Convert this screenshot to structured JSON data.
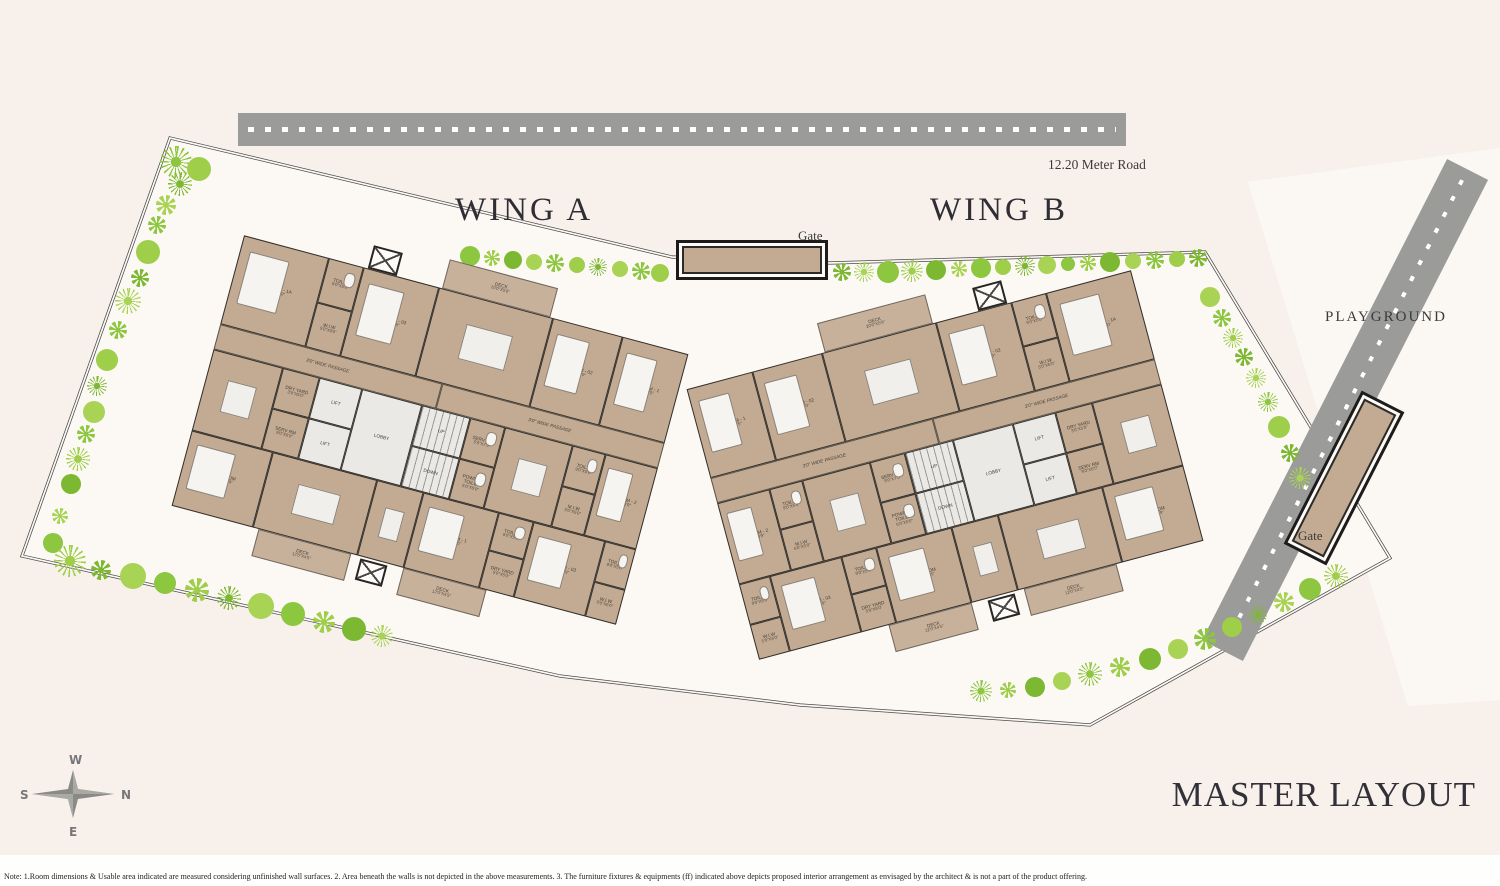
{
  "labels": {
    "wing_a": "WING A",
    "wing_b": "WING B",
    "playground": "PLAYGROUND",
    "road_top": "12.20 Meter Road",
    "gate_top": "Gate",
    "gate_right": "Gate",
    "master_title": "MASTER LAYOUT"
  },
  "compass": {
    "n": "N",
    "s": "S",
    "e": "E",
    "w": "W"
  },
  "note": "Note: 1.Room dimensions & Usable area indicated are measured considering unfinished wall surfaces. 2. Area beneath the walls is not depicted in the above measurements. 3. The furniture fixtures & equipments (ff) indicated above depicts proposed interior arrangement as envisaged by the architect & is not a part of the product offering.",
  "colors": {
    "background": "#f8f1eb",
    "site_fill": "#fcf9f5",
    "building_tan": "#c2aa93",
    "core_gray": "#eae9e6",
    "wall_dark": "#2e2c28",
    "road_gray": "#9b9b99",
    "tree_greens": [
      "#8dc63f",
      "#9fce4a",
      "#7db832",
      "#a8d355"
    ],
    "title_ink": "#32313a"
  },
  "wings": [
    {
      "id": "wing-a-plan",
      "mirror": false,
      "rooms": [
        {
          "l": "BEDROOM - 1A",
          "d": "20'6\"X14'0\"",
          "x": 0,
          "y": 0,
          "w": 88,
          "h": 92,
          "t": "r",
          "f": "bed"
        },
        {
          "l": "TOILET",
          "d": "9'0\"X5'0\"",
          "x": 88,
          "y": 0,
          "w": 36,
          "h": 46,
          "t": "r",
          "f": "fix"
        },
        {
          "l": "W.I.W",
          "d": "5'0\"X6'0\"",
          "x": 88,
          "y": 46,
          "w": 36,
          "h": 46,
          "t": "r"
        },
        {
          "l": "BEDROOM - 03",
          "d": "11'2\"X13'9\"",
          "x": 124,
          "y": 0,
          "w": 78,
          "h": 92,
          "t": "r",
          "f": "bed"
        },
        {
          "l": "LIVING ROOM",
          "d": "12'0\"X21'9\"",
          "x": 202,
          "y": 0,
          "w": 118,
          "h": 92,
          "t": "r",
          "f": "tbl"
        },
        {
          "l": "BEDROOM - 02",
          "d": "11'0\"X13'0\"",
          "x": 320,
          "y": 0,
          "w": 72,
          "h": 92,
          "t": "r",
          "f": "bed"
        },
        {
          "l": "BEDROOM - 1",
          "d": "11'9\"X13'5\"",
          "x": 392,
          "y": 0,
          "w": 68,
          "h": 92,
          "t": "r",
          "f": "bed"
        },
        {
          "l": "DECK",
          "d": "20'0\"X5'9\"",
          "x": 205,
          "y": -30,
          "w": 112,
          "h": 30,
          "t": "d"
        },
        {
          "x": 128,
          "y": -24,
          "w": 30,
          "h": 24,
          "t": "s"
        },
        {
          "l": "3'0\" WIDE PASSAGE",
          "x": 0,
          "y": 92,
          "w": 230,
          "h": 26,
          "t": "p"
        },
        {
          "l": "3'0\" WIDE PASSAGE",
          "x": 230,
          "y": 92,
          "w": 230,
          "h": 26,
          "t": "p"
        },
        {
          "l": "KITCHEN",
          "d": "11'0\"X13'0\"",
          "x": 0,
          "y": 118,
          "w": 72,
          "h": 84,
          "t": "r",
          "f": "tbl"
        },
        {
          "l": "DRY YARD",
          "d": "3'6\"X5'0\"",
          "x": 72,
          "y": 118,
          "w": 38,
          "h": 42,
          "t": "r"
        },
        {
          "l": "SERV RM",
          "d": "9'0\"X6'0\"",
          "x": 72,
          "y": 160,
          "w": 38,
          "h": 42,
          "t": "r"
        },
        {
          "l": "LIFT",
          "x": 110,
          "y": 118,
          "w": 44,
          "h": 42,
          "t": "c"
        },
        {
          "l": "LIFT",
          "x": 110,
          "y": 160,
          "w": 44,
          "h": 42,
          "t": "c"
        },
        {
          "l": "LOBBY",
          "x": 154,
          "y": 118,
          "w": 62,
          "h": 84,
          "t": "c"
        },
        {
          "l": "UP",
          "x": 216,
          "y": 118,
          "w": 50,
          "h": 42,
          "t": "st"
        },
        {
          "l": "DOWN",
          "x": 216,
          "y": 160,
          "w": 50,
          "h": 42,
          "t": "st"
        },
        {
          "l": "SERV TOI",
          "d": "5'0\"X7'5\"",
          "x": 266,
          "y": 118,
          "w": 36,
          "h": 42,
          "t": "r",
          "f": "fix"
        },
        {
          "l": "POWDER TOILET",
          "d": "5'0\"X5'0\"",
          "x": 266,
          "y": 160,
          "w": 36,
          "h": 42,
          "t": "r",
          "f": "fix"
        },
        {
          "l": "KITCHEN",
          "d": "11'0\"X13'0\"",
          "x": 302,
          "y": 118,
          "w": 70,
          "h": 84,
          "t": "r",
          "f": "tbl"
        },
        {
          "l": "TOILET",
          "d": "9'0\"X5'0\"",
          "x": 372,
          "y": 118,
          "w": 34,
          "h": 42,
          "t": "r",
          "f": "fix"
        },
        {
          "l": "M.I.W",
          "d": "5'0\"X5'0\"",
          "x": 372,
          "y": 160,
          "w": 34,
          "h": 42,
          "t": "r"
        },
        {
          "l": "BEDROOM - 2",
          "d": "11'2\"X13'9\"",
          "x": 406,
          "y": 118,
          "w": 54,
          "h": 84,
          "t": "r",
          "f": "bed"
        },
        {
          "l": "BED ROOM",
          "d": "15'0\"X11'9\"",
          "x": 0,
          "y": 202,
          "w": 84,
          "h": 78,
          "t": "r",
          "f": "bed"
        },
        {
          "l": "LIVING ROOM",
          "d": "12'0\"X21'9\"",
          "x": 84,
          "y": 202,
          "w": 108,
          "h": 78,
          "t": "r",
          "f": "tbl"
        },
        {
          "l": "DINING",
          "d": "8'0\"X8'3\"",
          "x": 192,
          "y": 202,
          "w": 48,
          "h": 78,
          "t": "r",
          "f": "tbl"
        },
        {
          "l": "BEDROOM - 1",
          "d": "11'9\"X13'5\"",
          "x": 240,
          "y": 202,
          "w": 78,
          "h": 78,
          "t": "r",
          "f": "bed"
        },
        {
          "l": "TOILET",
          "d": "9'0\"X5'0\"",
          "x": 318,
          "y": 202,
          "w": 36,
          "h": 39,
          "t": "r",
          "f": "fix"
        },
        {
          "l": "DRY YARD",
          "d": "5'0\"X5'0\"",
          "x": 318,
          "y": 241,
          "w": 36,
          "h": 39,
          "t": "r"
        },
        {
          "l": "BEDROOM - 03",
          "d": "11'2\"X13'9\"",
          "x": 354,
          "y": 202,
          "w": 74,
          "h": 78,
          "t": "r",
          "f": "bed"
        },
        {
          "l": "TOILET",
          "d": "9'0\"X5'0\"",
          "x": 428,
          "y": 202,
          "w": 32,
          "h": 42,
          "t": "r",
          "f": "fix"
        },
        {
          "l": "W.I.W",
          "d": "5'0\"X6'0\"",
          "x": 428,
          "y": 244,
          "w": 32,
          "h": 36,
          "t": "r"
        },
        {
          "l": "DECK",
          "d": "12'0\"X4'5\"",
          "x": 90,
          "y": 280,
          "w": 96,
          "h": 28,
          "t": "d"
        },
        {
          "l": "DECK",
          "d": "12'0\"X4'5\"",
          "x": 240,
          "y": 280,
          "w": 86,
          "h": 28,
          "t": "d"
        },
        {
          "x": 196,
          "y": 282,
          "w": 28,
          "h": 22,
          "t": "s"
        }
      ]
    },
    {
      "id": "wing-b-plan",
      "mirror": true,
      "rooms": [
        {
          "l": "BEDROOM - 1A",
          "d": "20'6\"X14'0\"",
          "x": 0,
          "y": 0,
          "w": 88,
          "h": 92,
          "t": "r",
          "f": "bed"
        },
        {
          "l": "TOILET",
          "d": "9'0\"X5'0\"",
          "x": 88,
          "y": 0,
          "w": 36,
          "h": 46,
          "t": "r",
          "f": "fix"
        },
        {
          "l": "W.I.W",
          "d": "5'0\"X6'0\"",
          "x": 88,
          "y": 46,
          "w": 36,
          "h": 46,
          "t": "r"
        },
        {
          "l": "BEDROOM - 03",
          "d": "11'2\"X13'9\"",
          "x": 124,
          "y": 0,
          "w": 78,
          "h": 92,
          "t": "r",
          "f": "bed"
        },
        {
          "l": "LIVING ROOM",
          "d": "12'0\"X21'9\"",
          "x": 202,
          "y": 0,
          "w": 118,
          "h": 92,
          "t": "r",
          "f": "tbl"
        },
        {
          "l": "BEDROOM - 02",
          "d": "11'0\"X13'0\"",
          "x": 320,
          "y": 0,
          "w": 72,
          "h": 92,
          "t": "r",
          "f": "bed"
        },
        {
          "l": "BEDROOM - 1",
          "d": "11'9\"X13'5\"",
          "x": 392,
          "y": 0,
          "w": 68,
          "h": 92,
          "t": "r",
          "f": "bed"
        },
        {
          "l": "DECK",
          "d": "20'0\"X5'9\"",
          "x": 205,
          "y": -30,
          "w": 112,
          "h": 30,
          "t": "d"
        },
        {
          "x": 128,
          "y": -24,
          "w": 30,
          "h": 24,
          "t": "s"
        },
        {
          "l": "3'0\" WIDE PASSAGE",
          "x": 0,
          "y": 92,
          "w": 230,
          "h": 26,
          "t": "p"
        },
        {
          "l": "3'0\" WIDE PASSAGE",
          "x": 230,
          "y": 92,
          "w": 230,
          "h": 26,
          "t": "p"
        },
        {
          "l": "KITCHEN",
          "d": "11'0\"X13'0\"",
          "x": 0,
          "y": 118,
          "w": 72,
          "h": 84,
          "t": "r",
          "f": "tbl"
        },
        {
          "l": "DRY YARD",
          "d": "3'6\"X5'0\"",
          "x": 72,
          "y": 118,
          "w": 38,
          "h": 42,
          "t": "r"
        },
        {
          "l": "SERV RM",
          "d": "9'0\"X6'0\"",
          "x": 72,
          "y": 160,
          "w": 38,
          "h": 42,
          "t": "r"
        },
        {
          "l": "LIFT",
          "x": 110,
          "y": 118,
          "w": 44,
          "h": 42,
          "t": "c"
        },
        {
          "l": "LIFT",
          "x": 110,
          "y": 160,
          "w": 44,
          "h": 42,
          "t": "c"
        },
        {
          "l": "LOBBY",
          "x": 154,
          "y": 118,
          "w": 62,
          "h": 84,
          "t": "c"
        },
        {
          "l": "UP",
          "x": 216,
          "y": 118,
          "w": 50,
          "h": 42,
          "t": "st"
        },
        {
          "l": "DOWN",
          "x": 216,
          "y": 160,
          "w": 50,
          "h": 42,
          "t": "st"
        },
        {
          "l": "SERV TOI",
          "d": "5'0\"X7'5\"",
          "x": 266,
          "y": 118,
          "w": 36,
          "h": 42,
          "t": "r",
          "f": "fix"
        },
        {
          "l": "POWDER TOILET",
          "d": "5'0\"X5'0\"",
          "x": 266,
          "y": 160,
          "w": 36,
          "h": 42,
          "t": "r",
          "f": "fix"
        },
        {
          "l": "KITCHEN",
          "d": "11'0\"X13'0\"",
          "x": 302,
          "y": 118,
          "w": 70,
          "h": 84,
          "t": "r",
          "f": "tbl"
        },
        {
          "l": "TOILET",
          "d": "9'0\"X5'0\"",
          "x": 372,
          "y": 118,
          "w": 34,
          "h": 42,
          "t": "r",
          "f": "fix"
        },
        {
          "l": "M.I.W",
          "d": "5'0\"X5'0\"",
          "x": 372,
          "y": 160,
          "w": 34,
          "h": 42,
          "t": "r"
        },
        {
          "l": "BEDROOM - 2",
          "d": "11'2\"X13'9\"",
          "x": 406,
          "y": 118,
          "w": 54,
          "h": 84,
          "t": "r",
          "f": "bed"
        },
        {
          "l": "BED ROOM",
          "d": "15'0\"X11'9\"",
          "x": 0,
          "y": 202,
          "w": 84,
          "h": 78,
          "t": "r",
          "f": "bed"
        },
        {
          "l": "LIVING ROOM",
          "d": "12'0\"X21'9\"",
          "x": 84,
          "y": 202,
          "w": 108,
          "h": 78,
          "t": "r",
          "f": "tbl"
        },
        {
          "l": "DINING",
          "d": "8'0\"X8'3\"",
          "x": 192,
          "y": 202,
          "w": 48,
          "h": 78,
          "t": "r",
          "f": "tbl"
        },
        {
          "l": "BED ROOM",
          "d": "11'0\"X13'5\"",
          "x": 240,
          "y": 202,
          "w": 78,
          "h": 78,
          "t": "r",
          "f": "bed"
        },
        {
          "l": "TOILET",
          "d": "9'0\"X5'0\"",
          "x": 318,
          "y": 202,
          "w": 36,
          "h": 39,
          "t": "r",
          "f": "fix"
        },
        {
          "l": "DRY YARD",
          "d": "5'0\"X5'0\"",
          "x": 318,
          "y": 241,
          "w": 36,
          "h": 39,
          "t": "r"
        },
        {
          "l": "BEDROOM - 03",
          "d": "11'2\"X13'9\"",
          "x": 354,
          "y": 202,
          "w": 74,
          "h": 78,
          "t": "r",
          "f": "bed"
        },
        {
          "l": "TOILET",
          "d": "9'0\"X5'0\"",
          "x": 428,
          "y": 202,
          "w": 32,
          "h": 42,
          "t": "r",
          "f": "fix"
        },
        {
          "l": "W.I.W",
          "d": "5'0\"X6'0\"",
          "x": 428,
          "y": 244,
          "w": 32,
          "h": 36,
          "t": "r"
        },
        {
          "l": "DECK",
          "d": "12'0\"X4'5\"",
          "x": 90,
          "y": 280,
          "w": 96,
          "h": 28,
          "t": "d"
        },
        {
          "l": "DECK",
          "d": "12'0\"X4'5\"",
          "x": 240,
          "y": 280,
          "w": 86,
          "h": 28,
          "t": "d"
        },
        {
          "x": 196,
          "y": 282,
          "w": 28,
          "h": 22,
          "t": "s"
        }
      ]
    }
  ],
  "landscape": {
    "trees": [
      [
        176,
        162,
        16,
        2
      ],
      [
        199,
        169,
        12,
        0
      ],
      [
        180,
        184,
        12,
        2
      ],
      [
        166,
        205,
        10,
        1
      ],
      [
        157,
        225,
        9,
        1
      ],
      [
        148,
        252,
        12,
        0
      ],
      [
        140,
        278,
        9,
        1
      ],
      [
        128,
        301,
        13,
        2
      ],
      [
        118,
        330,
        9,
        1
      ],
      [
        107,
        360,
        11,
        0
      ],
      [
        97,
        386,
        10,
        2
      ],
      [
        94,
        412,
        11,
        0
      ],
      [
        86,
        434,
        9,
        1
      ],
      [
        78,
        459,
        12,
        2
      ],
      [
        71,
        484,
        10,
        0
      ],
      [
        60,
        516,
        8,
        1
      ],
      [
        53,
        543,
        10,
        0
      ],
      [
        70,
        561,
        16,
        2
      ],
      [
        101,
        570,
        10,
        1
      ],
      [
        133,
        576,
        13,
        0
      ],
      [
        165,
        583,
        11,
        0
      ],
      [
        197,
        590,
        12,
        1
      ],
      [
        229,
        598,
        12,
        2
      ],
      [
        261,
        606,
        13,
        0
      ],
      [
        293,
        614,
        12,
        0
      ],
      [
        324,
        622,
        11,
        1
      ],
      [
        354,
        629,
        12,
        0
      ],
      [
        382,
        636,
        11,
        2
      ],
      [
        470,
        256,
        10,
        0
      ],
      [
        492,
        258,
        8,
        1
      ],
      [
        513,
        260,
        9,
        0
      ],
      [
        534,
        262,
        8,
        0
      ],
      [
        555,
        263,
        9,
        1
      ],
      [
        577,
        265,
        8,
        0
      ],
      [
        598,
        267,
        9,
        2
      ],
      [
        620,
        269,
        8,
        0
      ],
      [
        641,
        271,
        9,
        1
      ],
      [
        660,
        273,
        9,
        0
      ],
      [
        842,
        272,
        9,
        1
      ],
      [
        864,
        272,
        10,
        2
      ],
      [
        888,
        272,
        11,
        0
      ],
      [
        912,
        271,
        11,
        2
      ],
      [
        936,
        270,
        10,
        0
      ],
      [
        959,
        269,
        8,
        1
      ],
      [
        981,
        268,
        10,
        0
      ],
      [
        1003,
        267,
        8,
        0
      ],
      [
        1025,
        266,
        10,
        2
      ],
      [
        1047,
        265,
        9,
        0
      ],
      [
        1068,
        264,
        7,
        0
      ],
      [
        1088,
        263,
        8,
        1
      ],
      [
        1110,
        262,
        10,
        0
      ],
      [
        1133,
        261,
        8,
        0
      ],
      [
        1155,
        260,
        9,
        1
      ],
      [
        1177,
        259,
        8,
        0
      ],
      [
        1198,
        258,
        9,
        1
      ],
      [
        1210,
        297,
        10,
        0
      ],
      [
        1222,
        318,
        9,
        1
      ],
      [
        1233,
        338,
        10,
        2
      ],
      [
        1244,
        357,
        9,
        1
      ],
      [
        1256,
        378,
        10,
        2
      ],
      [
        1268,
        402,
        10,
        2
      ],
      [
        1279,
        427,
        11,
        0
      ],
      [
        1290,
        453,
        9,
        1
      ],
      [
        1300,
        478,
        11,
        2
      ],
      [
        981,
        691,
        11,
        2
      ],
      [
        1008,
        690,
        8,
        1
      ],
      [
        1035,
        687,
        10,
        0
      ],
      [
        1062,
        681,
        9,
        0
      ],
      [
        1090,
        674,
        12,
        2
      ],
      [
        1120,
        667,
        10,
        1
      ],
      [
        1150,
        659,
        11,
        0
      ],
      [
        1178,
        649,
        10,
        0
      ],
      [
        1205,
        639,
        11,
        1
      ],
      [
        1232,
        627,
        10,
        0
      ],
      [
        1258,
        615,
        9,
        2
      ],
      [
        1284,
        602,
        10,
        1
      ],
      [
        1310,
        589,
        11,
        0
      ],
      [
        1336,
        576,
        12,
        2
      ]
    ]
  }
}
